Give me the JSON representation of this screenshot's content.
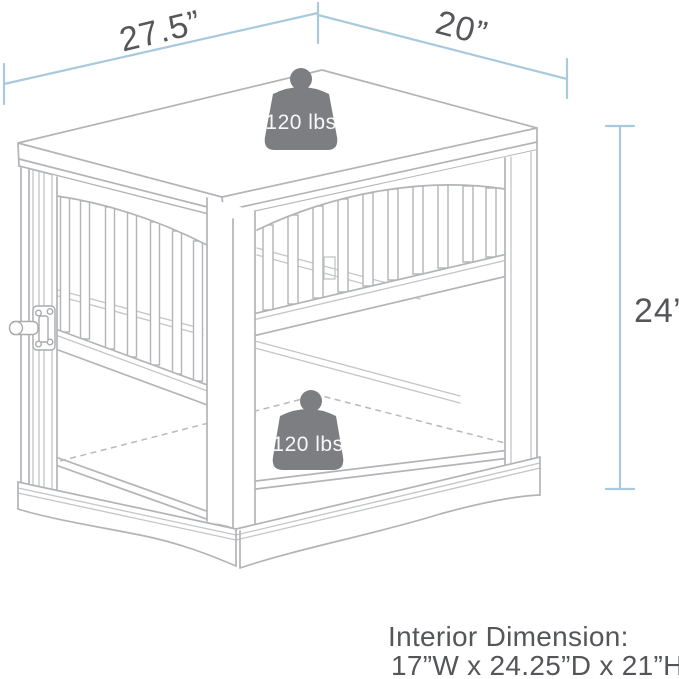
{
  "diagram": {
    "subject": "pet-crate-end-table-line-drawing",
    "dimension_labels": {
      "top_width": "27.5”",
      "top_depth": "20”",
      "side_height": "24”"
    },
    "weight_capacity": {
      "top_label": "120 lbs",
      "interior_label": "120 lbs"
    },
    "interior_dimension": {
      "title": "Interior Dimension:",
      "value": "17”W x 24.25”D x 21”H"
    },
    "colors": {
      "dimension_line_blue": "#a9cadd",
      "drawing_line_gray": "#b2b4b7",
      "label_text_gray": "#54565a",
      "weight_fill_gray": "#7c7e81",
      "weight_label_white": "#f7f7f7",
      "background": "#ffffff"
    }
  }
}
